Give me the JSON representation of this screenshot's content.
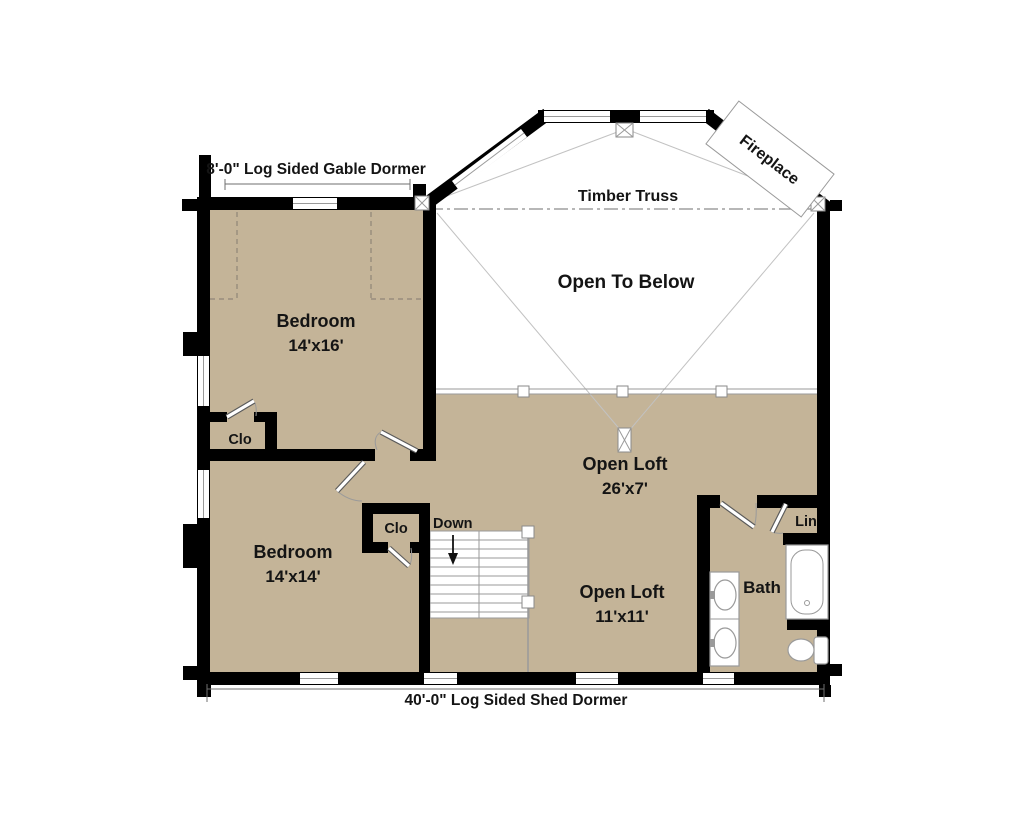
{
  "colors": {
    "floor_tan": "#c4b498",
    "wall_black": "#000000",
    "thin_line_gray": "#9a9a9a",
    "paper_white": "#ffffff"
  },
  "dimensions": {
    "gable_dormer": "8'-0\" Log Sided Gable Dormer",
    "shed_dormer": "40'-0\" Log Sided Shed Dormer"
  },
  "annotations": {
    "timber_truss": "Timber Truss",
    "fireplace": "Fireplace",
    "open_to_below": "Open To Below",
    "down": "Down"
  },
  "rooms": {
    "bedroom_upper": {
      "name": "Bedroom",
      "size": "14'x16'"
    },
    "bedroom_lower": {
      "name": "Bedroom",
      "size": "14'x14'"
    },
    "loft_upper": {
      "name": "Open Loft",
      "size": "26'x7'"
    },
    "loft_lower": {
      "name": "Open Loft",
      "size": "11'x11'"
    },
    "bath": {
      "name": "Bath"
    },
    "linen": {
      "name": "Lin"
    },
    "closet_upper": {
      "name": "Clo"
    },
    "closet_lower": {
      "name": "Clo"
    }
  }
}
